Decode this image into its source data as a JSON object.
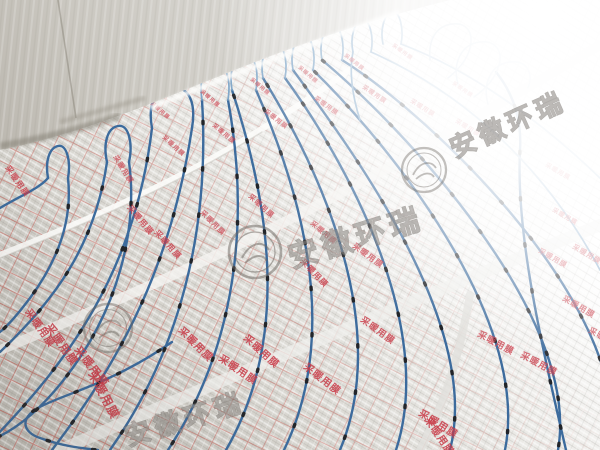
{
  "image": {
    "type": "photograph",
    "subject": "Electric floor-heating blue cable laid in serpentine loops over silver foil-faced insulation film in an unfinished concrete room",
    "width": 600,
    "height": 450
  },
  "watermark": {
    "text": "安徽环瑞",
    "logo": "circular-emblem-stamp",
    "repeats": 3
  },
  "foil_print": {
    "text": "采暖用膜",
    "color": "#c93a47",
    "instances": [
      {
        "x": 150,
        "y": 104,
        "s": 5,
        "r": 40
      },
      {
        "x": 200,
        "y": 92,
        "s": 5,
        "r": 40
      },
      {
        "x": 250,
        "y": 80,
        "s": 5,
        "r": 40
      },
      {
        "x": 298,
        "y": 68,
        "s": 5,
        "r": 40
      },
      {
        "x": 344,
        "y": 56,
        "s": 5,
        "r": 38
      },
      {
        "x": 392,
        "y": 46,
        "s": 5,
        "r": 36
      },
      {
        "x": 452,
        "y": 84,
        "s": 5,
        "r": 34
      },
      {
        "x": 162,
        "y": 138,
        "s": 6,
        "r": 42
      },
      {
        "x": 212,
        "y": 126,
        "s": 6,
        "r": 40
      },
      {
        "x": 264,
        "y": 112,
        "s": 6,
        "r": 38
      },
      {
        "x": 314,
        "y": 99,
        "s": 6,
        "r": 36
      },
      {
        "x": 362,
        "y": 88,
        "s": 6,
        "r": 34
      },
      {
        "x": 410,
        "y": 102,
        "s": 6,
        "r": 32
      },
      {
        "x": 455,
        "y": 122,
        "s": 6,
        "r": 32
      },
      {
        "x": 113,
        "y": 157,
        "s": 7,
        "r": 58
      },
      {
        "x": 5,
        "y": 168,
        "s": 8,
        "r": 55
      },
      {
        "x": 127,
        "y": 208,
        "s": 8,
        "r": 50
      },
      {
        "x": 154,
        "y": 233,
        "s": 8,
        "r": 48
      },
      {
        "x": 200,
        "y": 213,
        "s": 7,
        "r": 45
      },
      {
        "x": 248,
        "y": 197,
        "s": 7,
        "r": 42
      },
      {
        "x": 310,
        "y": 224,
        "s": 7,
        "r": 40
      },
      {
        "x": 352,
        "y": 247,
        "s": 8,
        "r": 36
      },
      {
        "x": 300,
        "y": 262,
        "s": 8,
        "r": 46
      },
      {
        "x": 218,
        "y": 360,
        "s": 10,
        "r": 34
      },
      {
        "x": 25,
        "y": 312,
        "s": 10,
        "r": 55
      },
      {
        "x": 45,
        "y": 327,
        "s": 11,
        "r": 55
      },
      {
        "x": 74,
        "y": 350,
        "s": 11,
        "r": 52
      },
      {
        "x": 88,
        "y": 374,
        "s": 12,
        "r": 62
      },
      {
        "x": 178,
        "y": 331,
        "s": 10,
        "r": 45
      },
      {
        "x": 243,
        "y": 339,
        "s": 10,
        "r": 42
      },
      {
        "x": 303,
        "y": 368,
        "s": 10,
        "r": 38
      },
      {
        "x": 360,
        "y": 321,
        "s": 9,
        "r": 36
      },
      {
        "x": 418,
        "y": 415,
        "s": 10,
        "r": 32
      },
      {
        "x": 477,
        "y": 336,
        "s": 9,
        "r": 28
      },
      {
        "x": 520,
        "y": 357,
        "s": 9,
        "r": 28
      },
      {
        "x": 424,
        "y": 420,
        "s": 10,
        "r": 55
      },
      {
        "x": 545,
        "y": 166,
        "s": 6,
        "r": 30
      },
      {
        "x": 552,
        "y": 211,
        "s": 6,
        "r": 30
      },
      {
        "x": 538,
        "y": 252,
        "s": 7,
        "r": 30
      },
      {
        "x": 572,
        "y": 248,
        "s": 7,
        "r": 30
      },
      {
        "x": 562,
        "y": 300,
        "s": 8,
        "r": 30
      },
      {
        "x": 588,
        "y": 332,
        "s": 8,
        "r": 28
      }
    ]
  },
  "scene": {
    "wall": "bare gray concrete wall at top-left with corner and dirt smudges",
    "floor": "reflective foil insulation with printed red grid and repeated red characters",
    "cable": "blue resistance heating cable laid in parallel serpentine runs",
    "clips": "small black fixing clips spaced along each cable run",
    "lighting": "strong window glare washing out the far right of the floor"
  },
  "palette": {
    "cable_blue": "#3c6b9d",
    "cable_blue_far": "#7fa6c8",
    "clip_black": "#22252a",
    "foil_near": "#c6c3bc",
    "foil_light": "#d8d6d0",
    "wall_gray": "#cbc8c1",
    "print_red": "#c93a47",
    "overexposed_white": "#ffffff"
  }
}
